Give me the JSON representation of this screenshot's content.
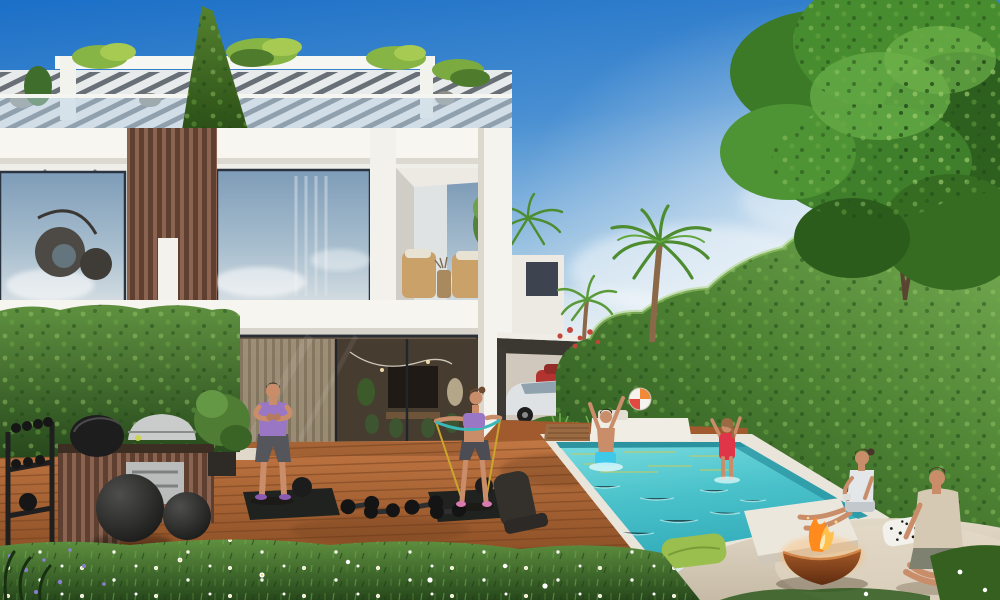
{
  "scene": {
    "kind": "architectural-render",
    "subject": "modern two-storey white villa backyard with rooftop garden, outdoor gym deck, BBQ station, swimming pool and fire-pit lounge",
    "time_of_day": "sunny day, clear blue sky"
  },
  "palette": {
    "sky_top": "#1b6fc7",
    "sky_horizon": "#dce8ee",
    "villa_white": "#f2f1ec",
    "wood_slat": "#7b5743",
    "hedge_light": "#7cb356",
    "hedge_dark": "#2e5a22",
    "tree_green": "#3f7f2b",
    "deck_light": "#c27743",
    "deck_dark": "#8a4e25",
    "pool_light": "#7adce0",
    "pool_deep": "#35aebc",
    "coping": "#e9e5da",
    "mat_black": "#20221f",
    "grass_dark": "#27481a",
    "patio_stone": "#d8cdba",
    "fire_bowl": "#8a4520",
    "flame_orange": "#ff8a1e",
    "skin": "#cf9572",
    "outfit_purple": "#9a77c4",
    "shorts_gray": "#55555c",
    "swim_cyan": "#3ec9e9",
    "swim_red": "#e03448",
    "ball_red": "#e04840",
    "ball_orange": "#f08a38",
    "pillow_green": "#9bbf4e",
    "pillow_bw": "#f2f1ec",
    "tee_beige": "#d6c9b4",
    "car_white": "#dfe2e4",
    "car_red": "#b23430"
  },
  "objects": [
    "villa-facade",
    "rooftop-pergola",
    "ivy-wedge",
    "glass-railing",
    "upper-window-egg-chair",
    "wood-slat-column",
    "balcony-rattan-chairs",
    "ground-floor-glass-wall",
    "left-hedge",
    "bbq-station",
    "kamado-grill",
    "gas-grill",
    "dumbbell-rack",
    "exercise-balls",
    "wood-deck",
    "exercise-mats",
    "dumbbells",
    "man-exercising",
    "woman-resistance-band",
    "carport",
    "white-suv",
    "red-car",
    "palm-trees",
    "right-hedge",
    "large-tree",
    "distant-building",
    "swimming-pool",
    "pool-loungers",
    "boy-in-pool",
    "girl-in-pool",
    "beach-ball",
    "stone-patio",
    "white-ledge",
    "fire-pit",
    "woman-sitting",
    "man-sitting",
    "green-pillow",
    "spotted-pillow",
    "foreground-grass",
    "daisies"
  ]
}
